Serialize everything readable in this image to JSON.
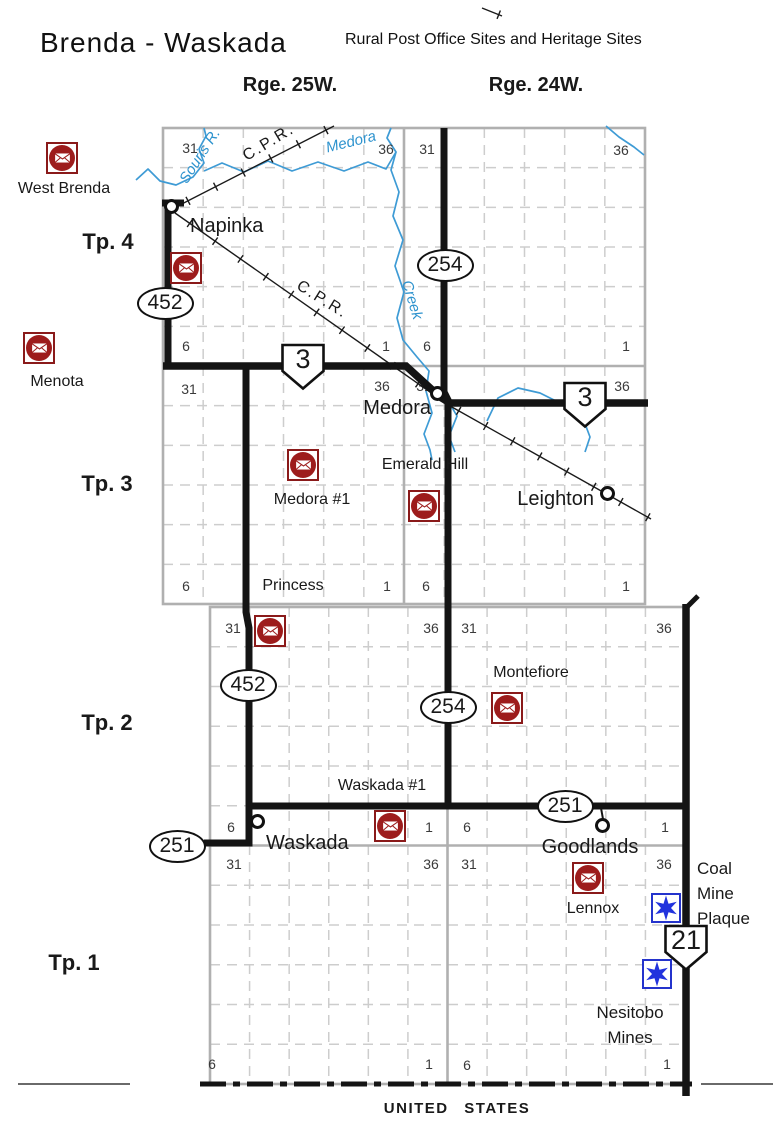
{
  "header": {
    "title": "Brenda - Waskada",
    "subtitle": "Rural Post Office Sites and Heritage Sites"
  },
  "range_labels": [
    {
      "text": "Rge. 25W.",
      "x": 290,
      "y": 74
    },
    {
      "text": "Rge. 24W.",
      "x": 536,
      "y": 74
    }
  ],
  "tp_labels": [
    {
      "text": "Tp. 4",
      "x": 108,
      "y": 229
    },
    {
      "text": "Tp. 3",
      "x": 107,
      "y": 471
    },
    {
      "text": "Tp. 2",
      "x": 107,
      "y": 710
    },
    {
      "text": "Tp. 1",
      "x": 74,
      "y": 950
    }
  ],
  "grids": [
    {
      "x": 163,
      "y": 128,
      "w": 482,
      "h": 476,
      "cols": 12,
      "rows": 12,
      "range_col": 6,
      "tp_row": 6
    },
    {
      "x": 210,
      "y": 607,
      "w": 475,
      "h": 477,
      "cols": 12,
      "rows": 12,
      "range_col": 6,
      "tp_row": 6
    }
  ],
  "sections": [
    {
      "n": "31",
      "x": 190,
      "y": 148
    },
    {
      "n": "36",
      "x": 386,
      "y": 149
    },
    {
      "n": "31",
      "x": 427,
      "y": 149
    },
    {
      "n": "36",
      "x": 621,
      "y": 150
    },
    {
      "n": "6",
      "x": 186,
      "y": 346
    },
    {
      "n": "1",
      "x": 386,
      "y": 346
    },
    {
      "n": "6",
      "x": 427,
      "y": 346
    },
    {
      "n": "1",
      "x": 626,
      "y": 346
    },
    {
      "n": "31",
      "x": 189,
      "y": 389
    },
    {
      "n": "36",
      "x": 382,
      "y": 386
    },
    {
      "n": "31",
      "x": 424,
      "y": 386
    },
    {
      "n": "36",
      "x": 622,
      "y": 386
    },
    {
      "n": "6",
      "x": 186,
      "y": 586
    },
    {
      "n": "1",
      "x": 387,
      "y": 586
    },
    {
      "n": "6",
      "x": 426,
      "y": 586
    },
    {
      "n": "1",
      "x": 626,
      "y": 586
    },
    {
      "n": "31",
      "x": 233,
      "y": 628
    },
    {
      "n": "36",
      "x": 431,
      "y": 628
    },
    {
      "n": "31",
      "x": 469,
      "y": 628
    },
    {
      "n": "36",
      "x": 664,
      "y": 628
    },
    {
      "n": "6",
      "x": 231,
      "y": 827
    },
    {
      "n": "1",
      "x": 429,
      "y": 827
    },
    {
      "n": "6",
      "x": 467,
      "y": 827
    },
    {
      "n": "1",
      "x": 665,
      "y": 827
    },
    {
      "n": "31",
      "x": 234,
      "y": 864
    },
    {
      "n": "36",
      "x": 431,
      "y": 864
    },
    {
      "n": "31",
      "x": 469,
      "y": 864
    },
    {
      "n": "36",
      "x": 664,
      "y": 864
    },
    {
      "n": "6",
      "x": 212,
      "y": 1064
    },
    {
      "n": "1",
      "x": 429,
      "y": 1064
    },
    {
      "n": "6",
      "x": 467,
      "y": 1065
    },
    {
      "n": "1",
      "x": 667,
      "y": 1064
    }
  ],
  "rivers": [
    {
      "id": "souris-river",
      "pts": [
        [
          136,
          180
        ],
        [
          148,
          169
        ],
        [
          160,
          181
        ],
        [
          176,
          185
        ],
        [
          193,
          177
        ],
        [
          204,
          163
        ],
        [
          199,
          149
        ],
        [
          206,
          136
        ],
        [
          204,
          128
        ]
      ]
    },
    {
      "id": "medora-creek-west",
      "pts": [
        [
          204,
          171
        ],
        [
          222,
          163
        ],
        [
          244,
          172
        ],
        [
          268,
          161
        ],
        [
          292,
          171
        ],
        [
          318,
          162
        ],
        [
          344,
          171
        ],
        [
          368,
          162
        ],
        [
          386,
          169
        ],
        [
          396,
          152
        ],
        [
          387,
          138
        ],
        [
          391,
          128
        ]
      ]
    },
    {
      "id": "medora-creek-main",
      "pts": [
        [
          396,
          152
        ],
        [
          391,
          170
        ],
        [
          399,
          192
        ],
        [
          393,
          216
        ],
        [
          403,
          240
        ],
        [
          395,
          266
        ],
        [
          404,
          292
        ],
        [
          397,
          318
        ],
        [
          403,
          340
        ],
        [
          417,
          357
        ],
        [
          429,
          371
        ],
        [
          426,
          391
        ],
        [
          432,
          413
        ],
        [
          424,
          434
        ],
        [
          430,
          450
        ],
        [
          432,
          460
        ]
      ]
    },
    {
      "id": "medora-creek-branch",
      "pts": [
        [
          447,
          399
        ],
        [
          457,
          416
        ],
        [
          449,
          436
        ],
        [
          455,
          452
        ]
      ]
    },
    {
      "id": "creek-east-of-medora",
      "pts": [
        [
          487,
          421
        ],
        [
          498,
          398
        ],
        [
          518,
          388
        ],
        [
          540,
          393
        ],
        [
          560,
          403
        ],
        [
          574,
          412
        ],
        [
          584,
          421
        ],
        [
          590,
          437
        ],
        [
          585,
          452
        ]
      ]
    },
    {
      "id": "creek-northeast-corner",
      "pts": [
        [
          606,
          126
        ],
        [
          619,
          137
        ],
        [
          634,
          147
        ],
        [
          644,
          155
        ]
      ]
    }
  ],
  "railways": [
    {
      "id": "cpr-northeast",
      "pts": [
        [
          172,
          209
        ],
        [
          334,
          126
        ]
      ]
    },
    {
      "id": "cpr-north-fragment",
      "pts": [
        [
          482,
          8
        ],
        [
          502,
          16
        ]
      ]
    },
    {
      "id": "cpr-southeast-west",
      "pts": [
        [
          175,
          213
        ],
        [
          440,
          399
        ]
      ]
    },
    {
      "id": "cpr-southeast-east",
      "pts": [
        [
          443,
          402
        ],
        [
          651,
          519
        ]
      ]
    }
  ],
  "roads": [
    {
      "id": "highway-452-north",
      "w": 7,
      "pts": [
        [
          168,
          203
        ],
        [
          168,
          366
        ]
      ]
    },
    {
      "id": "napinka-road-stub",
      "w": 7,
      "pts": [
        [
          162,
          203
        ],
        [
          184,
          203
        ]
      ]
    },
    {
      "id": "highway-3",
      "w": 7.5,
      "pts": [
        [
          163,
          366
        ],
        [
          406,
          366
        ],
        [
          440,
          397
        ],
        [
          450,
          403
        ],
        [
          648,
          403
        ]
      ]
    },
    {
      "id": "highway-254",
      "w": 7,
      "pts": [
        [
          444,
          128
        ],
        [
          444,
          392
        ],
        [
          448,
          400
        ],
        [
          448,
          806
        ]
      ]
    },
    {
      "id": "highway-452-south",
      "w": 7,
      "pts": [
        [
          246,
          366
        ],
        [
          246,
          612
        ],
        [
          249,
          628
        ],
        [
          249,
          843
        ],
        [
          204,
          843
        ]
      ]
    },
    {
      "id": "highway-251-waskada-road",
      "w": 7,
      "pts": [
        [
          248,
          806
        ],
        [
          686,
          806
        ]
      ]
    },
    {
      "id": "highway-21",
      "w": 7.5,
      "pts": [
        [
          686,
          604
        ],
        [
          686,
          1096
        ]
      ]
    },
    {
      "id": "highway-21-north-stub",
      "w": 5,
      "pts": [
        [
          686,
          608
        ],
        [
          698,
          596
        ]
      ]
    },
    {
      "id": "goodlands-stub",
      "w": 2,
      "pts": [
        [
          601,
          808
        ],
        [
          603,
          819
        ]
      ]
    }
  ],
  "towns": [
    {
      "label": "Napinka",
      "cx": 172,
      "cy": 207,
      "lx": 190,
      "ly": 215,
      "align": "left"
    },
    {
      "label": "Medora",
      "cx": 438,
      "cy": 394,
      "lx": 431,
      "ly": 397,
      "align": "right"
    },
    {
      "label": "Leighton",
      "cx": 608,
      "cy": 494,
      "lx": 594,
      "ly": 488,
      "align": "right"
    },
    {
      "label": "Waskada",
      "cx": 258,
      "cy": 822,
      "lx": 266,
      "ly": 832,
      "align": "left"
    },
    {
      "label": "Goodlands",
      "cx": 603,
      "cy": 826,
      "lx": 590,
      "ly": 836,
      "align": "center"
    }
  ],
  "post_offices": [
    {
      "id": "west-brenda",
      "label": "West Brenda",
      "ix": 62,
      "iy": 158,
      "lx": 64,
      "ly": 180,
      "align": "center"
    },
    {
      "id": "napinka-post-office",
      "label": "",
      "ix": 186,
      "iy": 268,
      "lx": 0,
      "ly": 0,
      "align": "center"
    },
    {
      "id": "menota",
      "label": "Menota",
      "ix": 39,
      "iy": 348,
      "lx": 57,
      "ly": 373,
      "align": "center"
    },
    {
      "id": "medora-1",
      "label": "Medora #1",
      "ix": 303,
      "iy": 465,
      "lx": 312,
      "ly": 491,
      "align": "center"
    },
    {
      "id": "emerald-hill",
      "label": "Emerald Hill",
      "ix": 424,
      "iy": 506,
      "lx": 425,
      "ly": 456,
      "align": "center"
    },
    {
      "id": "princess",
      "label": "Princess",
      "ix": 270,
      "iy": 631,
      "lx": 293,
      "ly": 577,
      "align": "center"
    },
    {
      "id": "montefiore",
      "label": "Montefiore",
      "ix": 507,
      "iy": 708,
      "lx": 531,
      "ly": 664,
      "align": "center"
    },
    {
      "id": "waskada-1",
      "label": "Waskada #1",
      "ix": 390,
      "iy": 826,
      "lx": 382,
      "ly": 777,
      "align": "center"
    },
    {
      "id": "lennox",
      "label": "Lennox",
      "ix": 588,
      "iy": 878,
      "lx": 593,
      "ly": 900,
      "align": "center"
    }
  ],
  "heritage_sites": [
    {
      "id": "coal-mine-plaque",
      "label_lines": [
        "Coal",
        "Mine",
        "Plaque"
      ],
      "ix": 666,
      "iy": 908,
      "lx": 697,
      "ly": 856,
      "align": "left"
    },
    {
      "id": "nesitobo-mines",
      "label_lines": [
        "Nesitobo",
        "Mines"
      ],
      "ix": 657,
      "iy": 974,
      "lx": 630,
      "ly": 1000,
      "align": "center"
    }
  ],
  "highway_markers": [
    {
      "type": "oval",
      "num": "452",
      "x": 165,
      "y": 303
    },
    {
      "type": "oval",
      "num": "254",
      "x": 445,
      "y": 265
    },
    {
      "type": "shield",
      "num": "3",
      "x": 303,
      "y": 366
    },
    {
      "type": "shield",
      "num": "3",
      "x": 585,
      "y": 404
    },
    {
      "type": "oval",
      "num": "452",
      "x": 248,
      "y": 685
    },
    {
      "type": "oval",
      "num": "254",
      "x": 448,
      "y": 707
    },
    {
      "type": "oval",
      "num": "251",
      "x": 177,
      "y": 846
    },
    {
      "type": "oval",
      "num": "251",
      "x": 565,
      "y": 806
    },
    {
      "type": "shield",
      "num": "21",
      "x": 686,
      "y": 947
    }
  ],
  "map_labels": [
    {
      "text": "Souris R.",
      "x": 200,
      "y": 156,
      "rot": -57,
      "cls": "water"
    },
    {
      "text": "Medora",
      "x": 351,
      "y": 142,
      "rot": -14,
      "cls": "water"
    },
    {
      "text": "Creek",
      "x": 412,
      "y": 300,
      "rot": 73,
      "cls": "water"
    },
    {
      "text": "C.P.R.",
      "x": 269,
      "y": 143,
      "rot": -31,
      "cls": "rail"
    },
    {
      "text": "C.P.R.",
      "x": 322,
      "y": 300,
      "rot": 32,
      "cls": "rail"
    }
  ],
  "us_border": {
    "label": "UNITED STATES",
    "label_x": 457,
    "label_y": 1100,
    "y": 1084,
    "dash_from": 200,
    "dash_to": 692,
    "solid_left": [
      18,
      130
    ],
    "solid_right": [
      701,
      773
    ]
  },
  "colors": {
    "road": "#141414",
    "river": "#3e9bd5",
    "grid": "#cdcdcd",
    "grid_bold": "#b0b0b0",
    "po_red": "#9d1c1c",
    "po_border": "#8a1a1a",
    "star_blue": "#2233dd",
    "rail": "#1a1a1a"
  }
}
